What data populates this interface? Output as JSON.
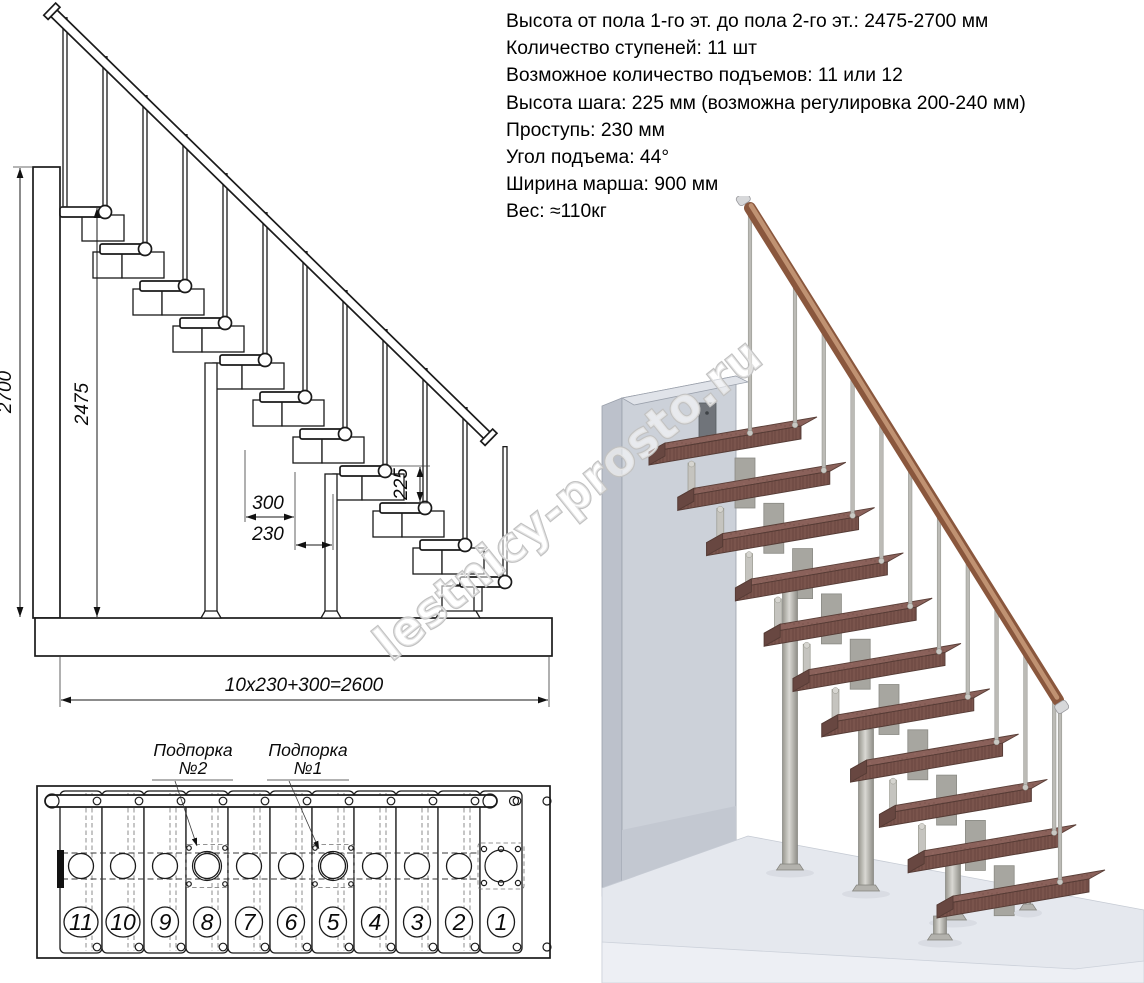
{
  "specs": {
    "lines": [
      "Высота от пола 1-го эт. до пола 2-го эт.: 2475-2700 мм",
      "Количество ступеней: 11 шт",
      "Возможное количество подъемов: 11 или 12",
      "Высота шага: 225 мм (возможна регулировка 200-240 мм)",
      "Проступь: 230 мм",
      "Угол подъема: 44°",
      "Ширина марша: 900 мм",
      "Вес: ≈110кг"
    ]
  },
  "elevation": {
    "steps_count": 11,
    "dims": {
      "total_height": "2700",
      "flight_height": "2475",
      "rise": "225",
      "tread_depth": "300",
      "run": "230",
      "total_run": "10x230+300=2600"
    }
  },
  "plan": {
    "step_numbers": [
      "11",
      "10",
      "9",
      "8",
      "7",
      "6",
      "5",
      "4",
      "3",
      "2",
      "1"
    ],
    "supports": [
      {
        "line1": "Подпорка",
        "line2": "№2"
      },
      {
        "line1": "Подпорка",
        "line2": "№1"
      }
    ]
  },
  "render3d": {
    "steps_count": 11
  },
  "watermark": {
    "text": "lestnicy-prosto.ru"
  },
  "colors": {
    "line": "#1a1a1a",
    "tread_top": "#8a615a",
    "tread_front": "#7a544c",
    "tread_side": "#684741",
    "metal": "#b7b6b1",
    "metal_dark": "#8f8f89",
    "handrail": "#8a573d",
    "handrail_light": "#c09272",
    "wall_front": "#ccd1d9",
    "wall_side": "#bcc1cb",
    "wall_top": "#e0e3e9",
    "floor_top": "#e5e8ee",
    "floor_front": "#edeff4",
    "watermark": "#c2c2c2"
  }
}
